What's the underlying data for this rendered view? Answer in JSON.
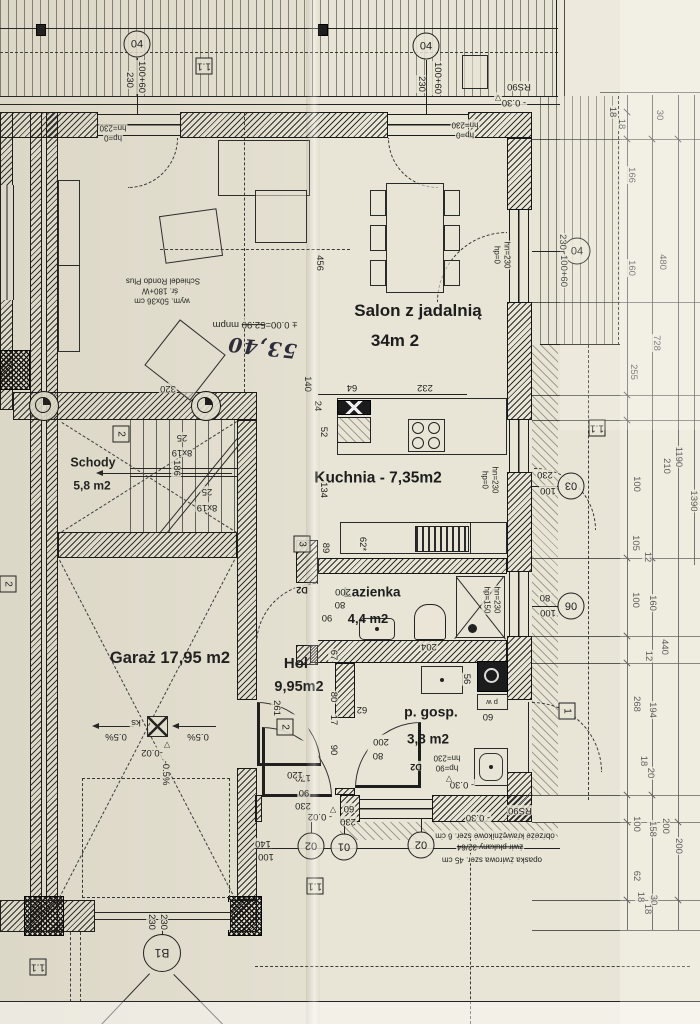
{
  "rooms": {
    "salon": {
      "name": "Salon z jadalnią",
      "area": "34m 2"
    },
    "kuchnia": {
      "name": "Kuchnia - 7,35m2"
    },
    "schody": {
      "name": "Schody",
      "area": "5,8 m2"
    },
    "garaz": {
      "name": "Garaż 17,95 m2"
    },
    "hol": {
      "name": "Hol",
      "area": "9,95m2"
    },
    "lazienka": {
      "name": "Łazienka",
      "area": "4,4 m2"
    },
    "pgosp": {
      "name": "p. gosp.",
      "area": "3,8 m2"
    }
  },
  "chimney": {
    "line1": "Schiedel Rondo Plus",
    "line2": "śr. 180+W",
    "line3": "wym. 50x36 cm"
  },
  "level": {
    "printed_a": "± 0.00=",
    "printed_b": "52.90",
    "printed_c": "mnpm",
    "handwritten": "53,40"
  },
  "win": {
    "hp0": "hp=0",
    "hn230": "hn=230",
    "hp150": "hp=150",
    "hp90": "hp=90"
  },
  "stairs": {
    "count": "8x19",
    "width": "25"
  },
  "garage": {
    "slope": "0.5%",
    "drain": "ks",
    "lvl": "-0.02",
    "slope_dir": "-0.5%"
  },
  "site": {
    "rs90": "RS90",
    "m030": "- 0.30",
    "m002": "- 0.02",
    "flag": "▽",
    "edge": "obrzeże krawężnikowe szer. 6 cm",
    "gravel": "żwir płukany 32/64",
    "band": "opaska żwirowa szer. 45 cm",
    "pw": "p w"
  },
  "markers": {
    "c04": "04",
    "c03": "03",
    "c06": "06",
    "c01": "01",
    "c02": "02",
    "b1": "B1",
    "s11": "1.1",
    "s2": "2",
    "s3": "3",
    "s1": "1",
    "d2": "D2"
  },
  "dims": {
    "top": [
      "100+60",
      "230"
    ],
    "right": [
      "18",
      "18",
      "30",
      "166",
      "480",
      "728",
      "160",
      "255",
      "1190",
      "210",
      "100",
      "1390",
      "105",
      "12",
      "100",
      "160",
      "440",
      "12",
      "268",
      "194",
      "18",
      "20",
      "100",
      "158",
      "200",
      "200",
      "62",
      "18",
      "30",
      "18"
    ],
    "salon": [
      "456",
      "320",
      "140",
      "64",
      "232"
    ],
    "kitchen": [
      "24",
      "52",
      "134",
      "186",
      "89",
      "62*"
    ],
    "hall": [
      "67",
      "80",
      "17",
      "90",
      "261",
      "170",
      "62",
      "56",
      "60"
    ],
    "bath": [
      "200",
      "80",
      "90",
      "204"
    ],
    "pg": [
      "200",
      "80"
    ],
    "rwall": [
      "230",
      "100",
      "80",
      "100"
    ],
    "bottom": [
      "120",
      "90",
      "230",
      "60",
      "230",
      "140",
      "100",
      "230",
      "230"
    ]
  }
}
